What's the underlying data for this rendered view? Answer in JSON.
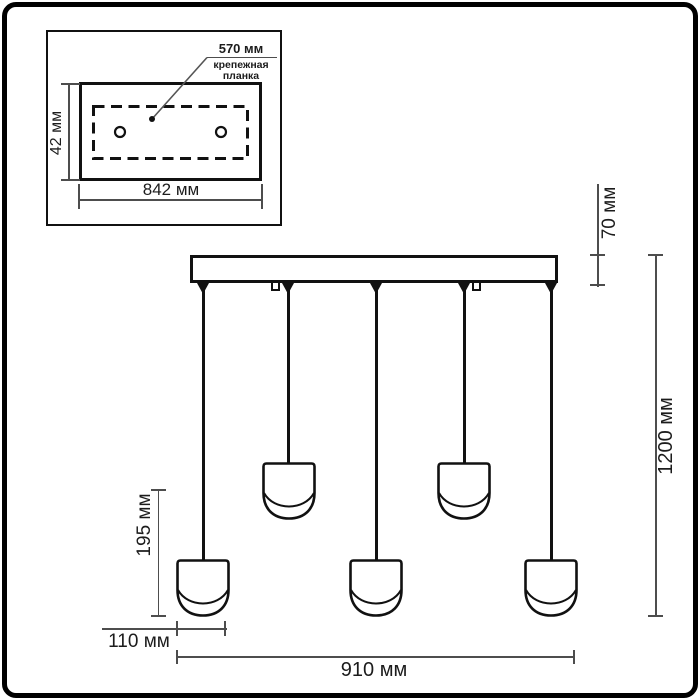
{
  "colors": {
    "ink": "#111111",
    "dimension_line": "#4d4d4d",
    "background": "#ffffff"
  },
  "inset": {
    "hole_spacing_label": "570 мм",
    "plate_label_line1": "крепежная",
    "plate_label_line2": "планка",
    "plate_height_label": "42 мм",
    "plate_width_label": "842 мм"
  },
  "main": {
    "canopy_height_label": "70 мм",
    "total_height_label": "1200 мм",
    "shade_drop_label": "195 мм",
    "shade_width_label": "110 мм",
    "span_width_label": "910 мм"
  }
}
